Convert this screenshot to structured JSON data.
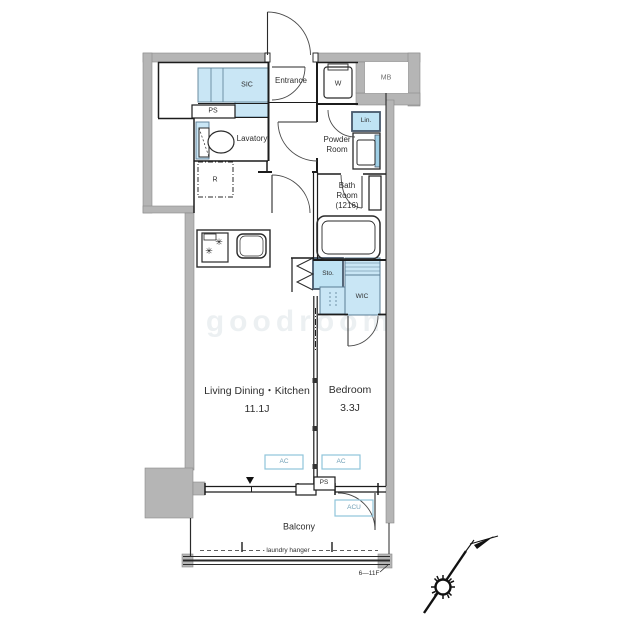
{
  "floorplan": {
    "labels": {
      "sic": "SIC",
      "ps_top": "PS",
      "entrance": "Entrance",
      "washer": "W",
      "meter_box": "MB",
      "linen": "Lin.",
      "lavatory": "Lavatory",
      "powder_line1": "Powder",
      "powder_line2": "Room",
      "bath_line1": "Bath",
      "bath_line2": "Room",
      "bath_line3": "(1216)",
      "refrigerator": "R",
      "storage": "Sto.",
      "wic": "WIC",
      "ldk_name": "Living Dining・Kitchen",
      "ldk_size": "11.1J",
      "bedroom_name": "Bedroom",
      "bedroom_size": "3.3J",
      "ac": "AC",
      "acu": "ACU",
      "ps_bottom": "PS",
      "balcony": "Balcony",
      "laundry_hanger": "laundry hanger",
      "floor_range": "6—11F",
      "watermark": "goodroom"
    },
    "colors": {
      "highlight_fill": "#c9e6f5",
      "closet_border": "#47586b",
      "wall_gray": "#b5b5b5",
      "ac_border": "#90c4da",
      "ac_text": "#6f9fb6",
      "line": "#1c1c1c",
      "watermark_gray": "#aebec7"
    },
    "icons": [
      "compass-north-icon",
      "stove-burner-icon",
      "sink-icon",
      "bathtub-icon",
      "toilet-icon",
      "washing-machine-icon"
    ]
  }
}
